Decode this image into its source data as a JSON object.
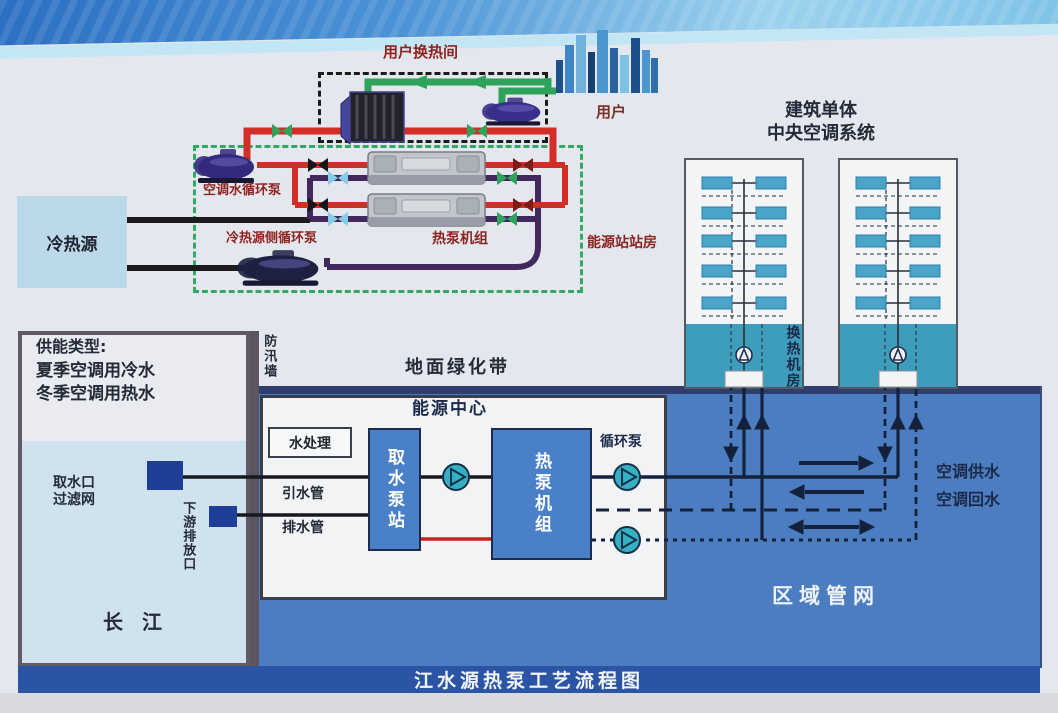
{
  "diagram_title": "江水源热泵工艺流程图",
  "upper": {
    "user_hx_room": "用户换热间",
    "user": "用户",
    "ac_water_pump": "空调水循环泵",
    "source_side_pump": "冷热源侧循环泵",
    "heat_pump_units": "热泵机组",
    "energy_station_room": "能源站站房",
    "cold_heat_source": "冷热源"
  },
  "buildings": {
    "title_line1": "建筑单体",
    "title_line2": "中央空调系统",
    "hx_machine_room": "换热机房"
  },
  "left": {
    "supply_type_title": "供能类型:",
    "supply_type_summer": "夏季空调用冷水",
    "supply_type_winter": "冬季空调用热水",
    "intake_line1": "取水口",
    "intake_line2": "过滤网",
    "downstream_outlet": "下游排放口",
    "river": "长  江"
  },
  "middle": {
    "flood_wall": "防汛墙",
    "green_belt": "地面绿化带",
    "energy_center": "能源中心",
    "water_treatment": "水处理",
    "intake_pump_station": "取水泵站",
    "heat_pump_unit": "热泵机组",
    "circulation_pump": "循环泵",
    "intake_pipe": "引水管",
    "drain_pipe": "排水管"
  },
  "network": {
    "ac_supply": "空调供水",
    "ac_return": "空调回水",
    "regional_network": "区域管网"
  },
  "colors": {
    "red_pipe": "#d22d26",
    "green_pipe": "#2fa25c",
    "purple_pipe": "#41295d",
    "navy_pipe": "#14213d",
    "region_blue": "#4c7dc0",
    "building_teal": "#3e9dbb",
    "river_blue": "#cfe2ee",
    "box_blue": "#4a80c8",
    "band_navy": "#2b55a4",
    "label_red": "#8d2420"
  }
}
